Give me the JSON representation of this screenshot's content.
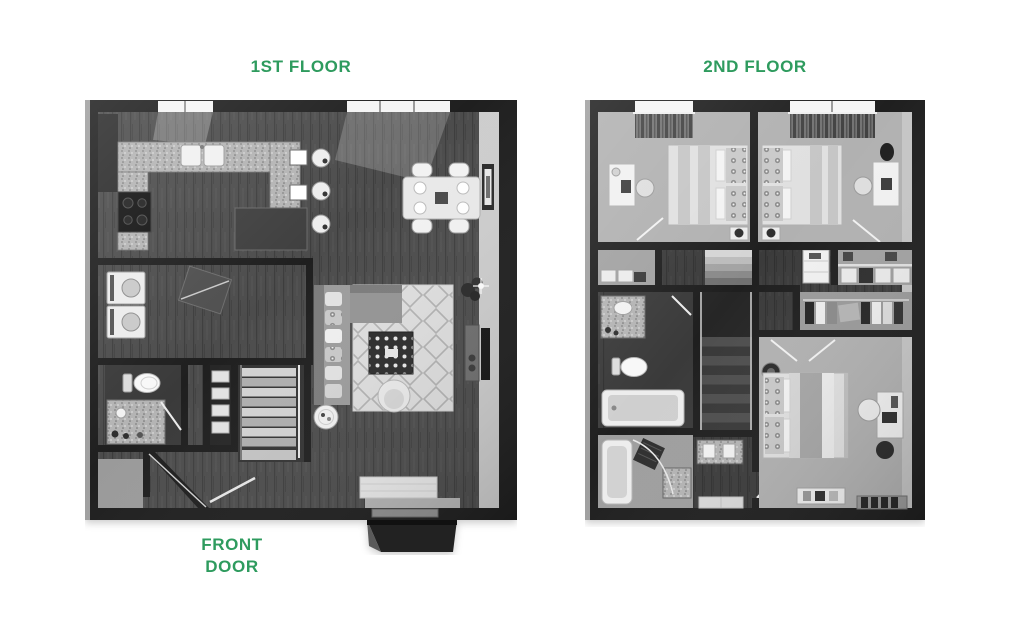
{
  "page": {
    "width": 1024,
    "height": 622,
    "background": "#ffffff"
  },
  "labels": {
    "first_floor_title": "1ST FLOOR",
    "second_floor_title": "2ND FLOOR",
    "front_door": "FRONT DOOR"
  },
  "style": {
    "label_color": "#2e9b5e",
    "wall_color": "#1f1f1f",
    "wood_floor_color": "#4c4c4c",
    "carpet_color": "#b1b1b1",
    "fixture_color": "#f2f2f2",
    "rendering": "grayscale 3D top-down floor plan"
  },
  "floorplans": {
    "first_floor": {
      "rooms": [
        "kitchen",
        "dining area",
        "living room",
        "laundry",
        "bathroom",
        "linen closet",
        "stairs",
        "entry",
        "front porch"
      ]
    },
    "second_floor": {
      "rooms": [
        "bedroom 1",
        "bedroom 2",
        "hall bathroom",
        "master bathroom",
        "walk-in closet",
        "hallway",
        "stairs",
        "master bedroom"
      ]
    }
  }
}
